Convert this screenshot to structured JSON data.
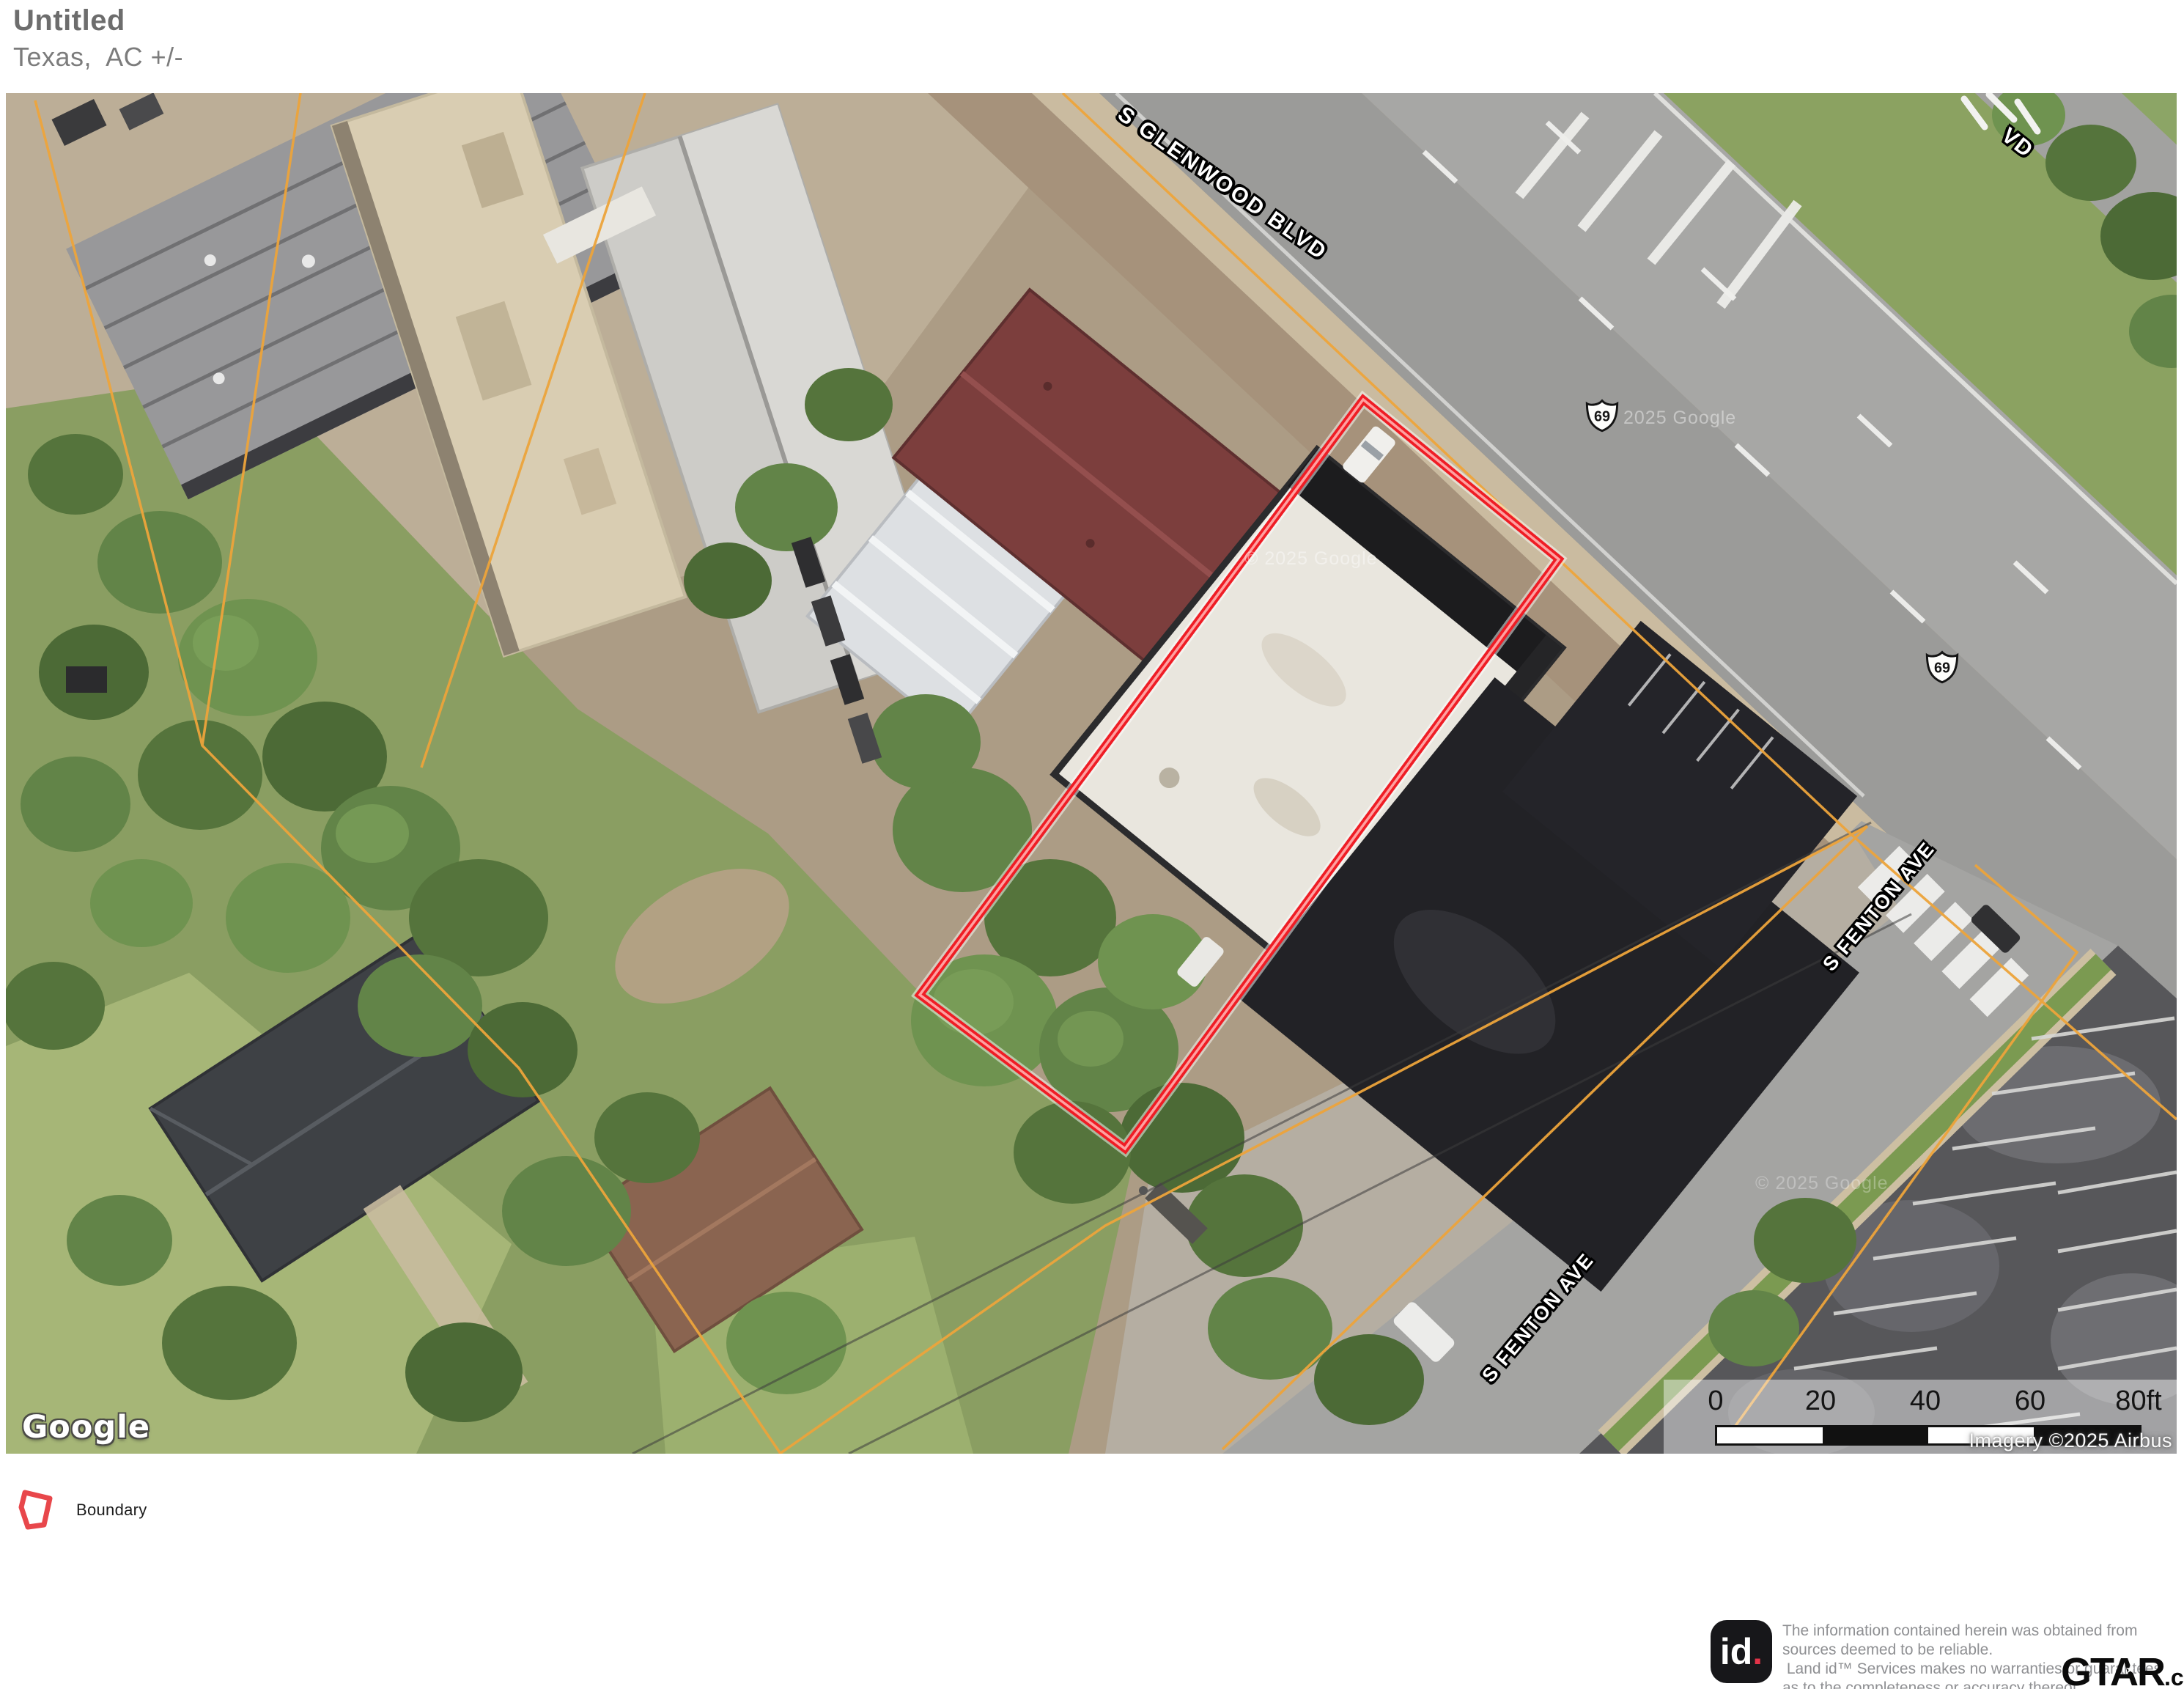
{
  "header": {
    "title": "Untitled",
    "subtitle": "Texas,  AC +/-"
  },
  "map": {
    "labels": {
      "glenwood": "S GLENWOOD BLVD",
      "vd": "VD",
      "fenton_upper": "S FENTON AVE",
      "fenton_lower": "S FENTON AVE",
      "shield_1": "69",
      "shield_2": "69",
      "watermark_1": "2025 Google",
      "watermark_2": "© 2025 Google",
      "watermark_3": "© 2025 Google"
    },
    "google_logo": "Google",
    "scale_bar": {
      "ticks": [
        "0",
        "20",
        "40",
        "60",
        "80ft"
      ]
    },
    "attribution": "Imagery ©2025 Airbus"
  },
  "legend": {
    "boundary_label": "Boundary"
  },
  "footer": {
    "logo": "id",
    "logo_dot": ".",
    "disclaimer": [
      "The information contained herein was obtained from",
      "sources deemed to be reliable.",
      " Land id™ Services makes no warranties or guarantees",
      "as to the completeness or accuracy thereof."
    ],
    "brand": "GTAR",
    "brand_suffix": ".com",
    "brand_star": "★"
  },
  "colors": {
    "boundary_red": "#ef1d25",
    "boundary_inner": "#ffa0a0",
    "parcel_orange": "#eda43b",
    "legend_red": "#e8474b"
  }
}
